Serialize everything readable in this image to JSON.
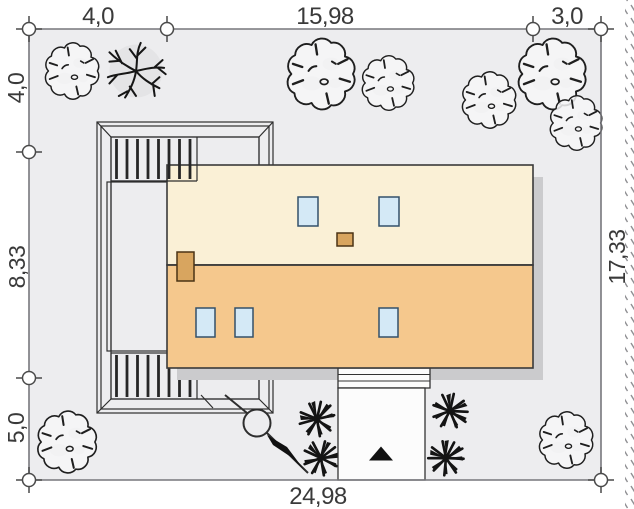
{
  "drawing": {
    "kind": "house plot site plan (roof view)",
    "plot_outline": "rectangular plot with survey circles at dimension points",
    "house": {
      "roof": "gabled roof, two slopes with ridge line",
      "skylight_count": 5,
      "chimney_count": 2,
      "left_annex": "terrace / pergola with slatted bands",
      "driveway": "entrance drive at bottom with steps and direction arrow"
    },
    "landscape": {
      "cloud_trees": 8,
      "branchy_tree": 1,
      "shrubs": 4,
      "lamp_posts": 1
    }
  },
  "dimensions": {
    "top": [
      {
        "label": "4,0"
      },
      {
        "label": "15,98"
      },
      {
        "label": "3,0"
      }
    ],
    "left": [
      {
        "label": "4,0"
      },
      {
        "label": "8,33"
      },
      {
        "label": "5,0"
      }
    ],
    "right": [
      {
        "label": "17,33"
      }
    ],
    "bottom": [
      {
        "label": "24,98"
      }
    ]
  },
  "measurements_m": {
    "plot_width_bottom": 24.98,
    "plot_depth_right": 17.33,
    "house_width": 15.98,
    "house_depth": 8.33,
    "setback_left": 4.0,
    "setback_right": 3.0,
    "setback_top": 4.0,
    "setback_bottom": 5.0
  },
  "colors": {
    "page_bg": "#ffffff",
    "plot_fill": "#ededef",
    "boundary_line": "#77777c",
    "marker_stroke": "#4a4a4a",
    "dimension_text": "#3a3a3a",
    "roof_upper": "#faf0d6",
    "roof_lower": "#f5c88d",
    "roof_outline": "#3a3a3a",
    "roof_shadow": "#cbcbcd",
    "skylight_fill": "#d4e9f6",
    "skylight_stroke": "#33506a",
    "chimney_fill": "#d8a55f",
    "structure_line": "#2e2e2e",
    "tree_stroke": "#1f1f1f",
    "tree_fill": "#f6f6f7",
    "tree_patch": "#d9d9db",
    "bush_color": "#141414",
    "driveway_fill": "#fcfcfc"
  }
}
